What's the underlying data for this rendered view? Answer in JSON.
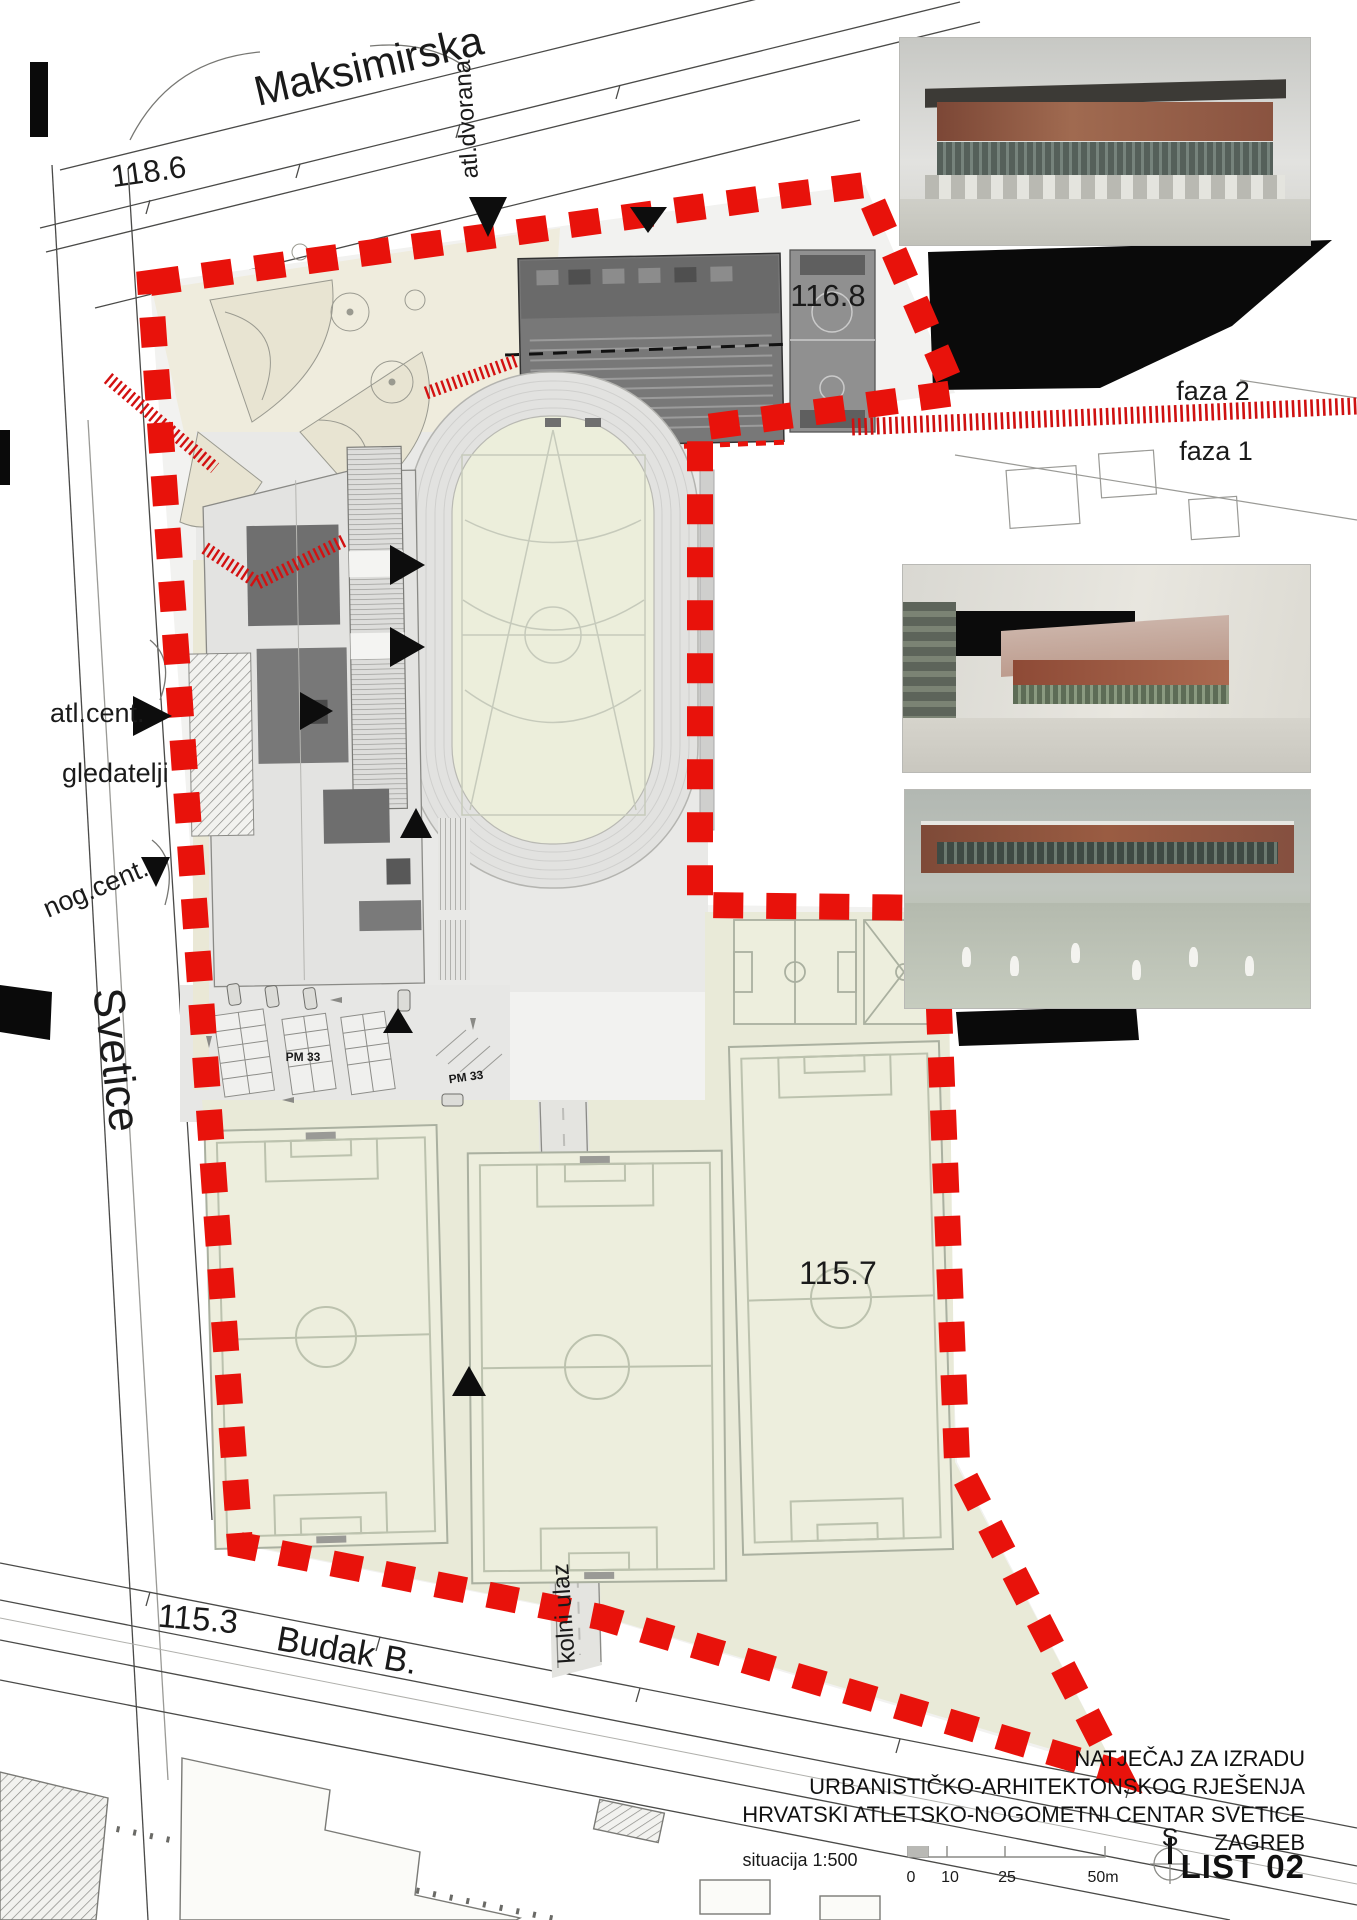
{
  "labels": {
    "street_top": "Maksimirska",
    "street_left": "Svetice",
    "street_bottom": "Budak B.",
    "elevation_118_6": "118.6",
    "elevation_116_8": "116.8",
    "elevation_115_3": "115.3",
    "elevation_115_7": "115.7",
    "phase_2": "faza 2",
    "phase_1": "faza 1",
    "athletic_hall": "atl.dvorana",
    "vehicle_entrance": "kolni ulaz",
    "athletic_center": "atl.cent.",
    "spectators": "gledatelji",
    "football_center": "nog.cent.",
    "parking_1": "PM 33",
    "parking_2": "PM 33"
  },
  "title_block": {
    "line_1": "NATJEČAJ ZA IZRADU",
    "line_2": "URBANISTIČKO-ARHITEKTONSKOG RJEŠENJA",
    "line_3": "HRVATSKI ATLETSKO-NOGOMETNI CENTAR SVETICE",
    "city": "ZAGREB",
    "sheet": "LIST 02",
    "north": "S"
  },
  "scale_bar": {
    "label": "situacija 1:500",
    "tick_0": "0",
    "tick_10": "10",
    "tick_25": "25",
    "tick_50": "50m"
  },
  "colors": {
    "boundary_red": "#e8120b",
    "hatch_red": "#d31111",
    "field_green": "#edeedd",
    "zone_olive": "#e9ead8",
    "hall_gray": "#787878",
    "black": "#0a0a0a"
  }
}
